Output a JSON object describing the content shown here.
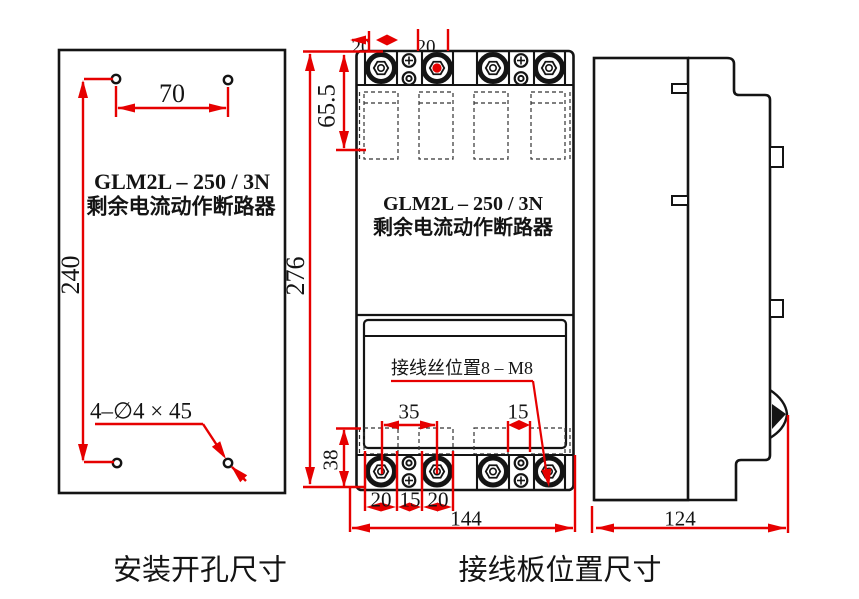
{
  "product": {
    "model": "GLM2L – 250 / 3N",
    "name": "剩余电流动作断路器"
  },
  "install_view": {
    "caption": "安装开孔尺寸",
    "dim_hole_spacing_width": "70",
    "dim_hole_spacing_height": "240",
    "hole_spec": "4–∅4 × 45"
  },
  "terminal_view": {
    "caption": "接线板位置尺寸",
    "note": "接线丝位置8 – M8",
    "dim_top_offset": "65.5",
    "dim_height": "276",
    "dim_block_height": "38",
    "dim_screw_span": "35",
    "dim_channel_gap": "15",
    "dim_cell_left": "20",
    "dim_cell_mid": "15",
    "dim_cell_right": "20",
    "dim_width": "144",
    "top_partial_left": "20",
    "top_partial_right": "20"
  },
  "side_view": {
    "dim_depth": "124"
  },
  "colors": {
    "dimension_red": "#e60000",
    "line_black": "#141414"
  }
}
